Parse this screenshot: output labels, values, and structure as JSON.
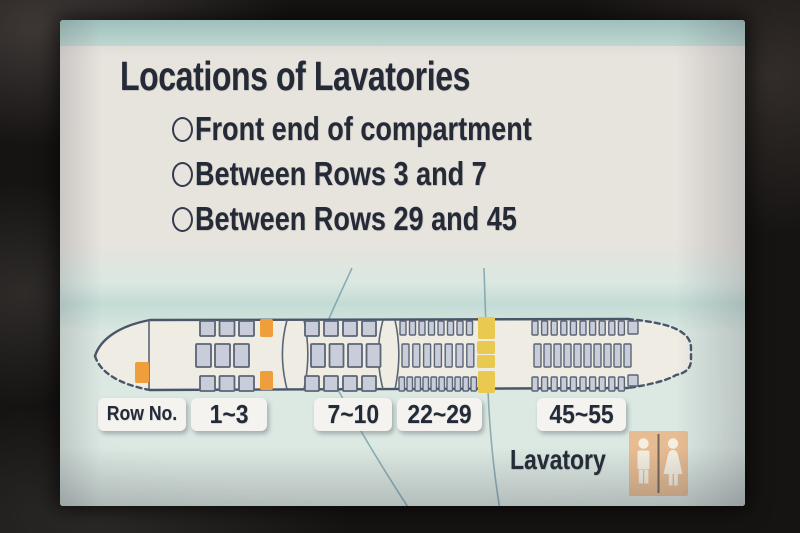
{
  "screen_title": "Locations of Lavatories",
  "options": [
    {
      "label": "Front end of compartment"
    },
    {
      "label": "Between Rows 3 and 7"
    },
    {
      "label": "Between Rows 29 and 45"
    }
  ],
  "row_labels": {
    "header": "Row No.",
    "ranges": [
      "1~3",
      "7~10",
      "22~29",
      "45~55"
    ]
  },
  "legend": {
    "label": "Lavatory"
  },
  "colors": {
    "lavatory_front": "#ee9f3c",
    "lavatory_aft": "#e9c94f",
    "seat_fill": "#c9cdd9",
    "seat_stroke": "#5a6575",
    "fuselage_fill": "#efece4",
    "fuselage_stroke": "#49566a",
    "header_band": "#b7d5cf",
    "map_line": "#6f9aa4",
    "restroom_icon_bg": "#e8bc92",
    "restroom_figure": "#f5efe2"
  },
  "seatmap": {
    "sections": [
      {
        "name": "rows_1_3",
        "style": "square",
        "bands": [
          {
            "pos": "top",
            "x": 112,
            "count": 3,
            "pitch": 19.5,
            "w": 15,
            "h": 15
          },
          {
            "pos": "mid",
            "x": 108,
            "count": 3,
            "pitch": 19,
            "w": 15,
            "h": 23
          },
          {
            "pos": "bot",
            "x": 112,
            "count": 3,
            "pitch": 19.5,
            "w": 15,
            "h": 15
          }
        ]
      },
      {
        "name": "rows_7_10",
        "style": "square",
        "bands": [
          {
            "pos": "top",
            "x": 217,
            "count": 4,
            "pitch": 19,
            "w": 14,
            "h": 15
          },
          {
            "pos": "mid",
            "x": 223,
            "count": 4,
            "pitch": 18.5,
            "w": 14,
            "h": 23
          },
          {
            "pos": "bot",
            "x": 217,
            "count": 4,
            "pitch": 19,
            "w": 14,
            "h": 15
          }
        ]
      },
      {
        "name": "rows_22_29",
        "style": "strip",
        "bands": [
          {
            "pos": "top",
            "x": 312,
            "count": 8,
            "pitch": 9.5,
            "w": 6,
            "h": 14
          },
          {
            "pos": "mid",
            "x": 314,
            "count": 7,
            "pitch": 10.8,
            "w": 7,
            "h": 23
          },
          {
            "pos": "bot",
            "x": 311,
            "count": 10,
            "pitch": 8,
            "w": 5.5,
            "h": 14
          }
        ]
      },
      {
        "name": "rows_45_55",
        "style": "strip",
        "bands": [
          {
            "pos": "top",
            "x": 444,
            "count": 10,
            "pitch": 9.6,
            "w": 6,
            "h": 14,
            "extra": {
              "x": 540,
              "w": 10,
              "h": 13
            }
          },
          {
            "pos": "mid",
            "x": 446,
            "count": 10,
            "pitch": 10,
            "w": 7,
            "h": 23
          },
          {
            "pos": "bot",
            "x": 444,
            "count": 10,
            "pitch": 9.6,
            "w": 6,
            "h": 14,
            "extra": {
              "x": 540,
              "w": 10,
              "h": 11,
              "y": 65
            }
          }
        ]
      }
    ],
    "lavatories": [
      {
        "loc": "front-end",
        "x": 47,
        "y": 52,
        "w": 14,
        "h": 21,
        "color": "front"
      },
      {
        "loc": "between-3-7-top",
        "x": 172,
        "y": 9,
        "w": 13,
        "h": 18,
        "color": "front"
      },
      {
        "loc": "between-3-7-bottom",
        "x": 172,
        "y": 61,
        "w": 13,
        "h": 19,
        "color": "front"
      },
      {
        "loc": "between-29-45-top",
        "x": 390,
        "y": 7,
        "w": 17,
        "h": 22,
        "color": "aft"
      },
      {
        "loc": "between-29-45-mid-upper",
        "x": 389,
        "y": 31,
        "w": 18,
        "h": 13,
        "color": "aft"
      },
      {
        "loc": "between-29-45-mid-lower",
        "x": 389,
        "y": 45,
        "w": 18,
        "h": 13,
        "color": "aft"
      },
      {
        "loc": "between-29-45-bottom",
        "x": 390,
        "y": 61,
        "w": 17,
        "h": 22,
        "color": "aft"
      }
    ]
  }
}
